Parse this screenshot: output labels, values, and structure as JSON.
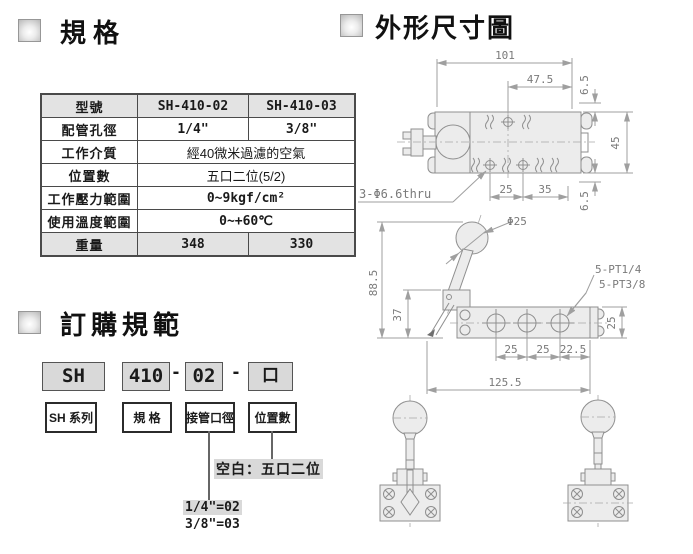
{
  "headings": {
    "specs": "規格",
    "dimensions": "外形尺寸圖",
    "ordering": "訂購規範"
  },
  "spec_table": {
    "rows": [
      {
        "label": "型號",
        "a": "SH-410-02",
        "b": "SH-410-03"
      },
      {
        "label": "配管孔徑",
        "a": "1/4\"",
        "b": "3/8\""
      },
      {
        "label": "工作介質",
        "span": "經40微米過濾的空氣"
      },
      {
        "label": "位置數",
        "span": "五口二位(5/2)"
      },
      {
        "label": "工作壓力範圍",
        "span": "0~9kgf/cm²"
      },
      {
        "label": "使用溫度範圍",
        "span": "0~+60℃"
      },
      {
        "label": "重量",
        "a": "348",
        "b": "330"
      }
    ]
  },
  "ordering": {
    "sep": "-",
    "code": [
      {
        "text": "SH",
        "label": "SH 系列"
      },
      {
        "text": "410",
        "label": "規 格"
      },
      {
        "text": "02",
        "label": "接管口徑"
      },
      {
        "text": "口",
        "label": "位置數"
      }
    ],
    "notes": {
      "blank": "空白：五口二位",
      "quarter": "1/4\"=02",
      "three_eighths": "3/8\"=03"
    }
  },
  "drawing": {
    "top": {
      "width": "101",
      "width_half": "47.5",
      "ear_top": "6.5",
      "height": "45",
      "ear_bottom": "6.5",
      "hole_pitch": "25",
      "hole_edge": "35",
      "holes": "3-Φ6.6thru"
    },
    "front": {
      "knob": "Φ25",
      "height": "88.5",
      "pivot": "37",
      "body": "25",
      "p1": "25",
      "p2": "25",
      "p3": "22.5",
      "length": "125.5",
      "pt_a": "5-PT1/4",
      "pt_b": "5-PT3/8"
    }
  },
  "colors": {
    "header_bg": "#e3e3e3",
    "highlight_bg": "#d9d9d9",
    "shadow": "#161616",
    "part_line": "#8f8f8f",
    "dim_line": "#9f9f9f",
    "dim_text": "#7a7a7a"
  }
}
